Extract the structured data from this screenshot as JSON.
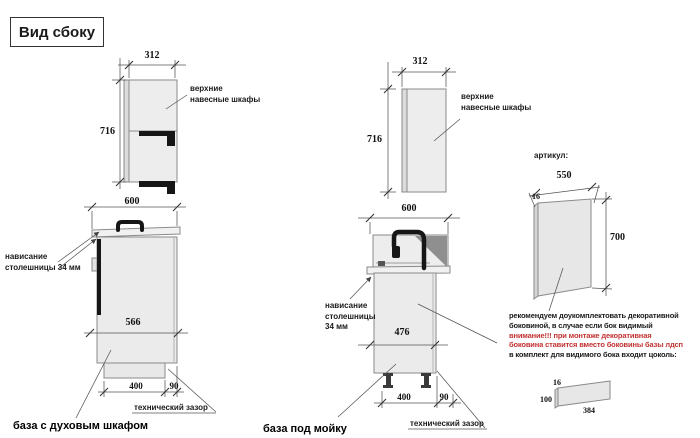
{
  "title": "Вид сбоку",
  "left_unit": {
    "wall_label": "верхние навесные шкафы",
    "overhang_label": "нависание столешницы 34 мм",
    "tech_gap_label": "технический зазор",
    "name_label": "база с духовым шкафом",
    "dims": {
      "wall_width": "312",
      "wall_height": "716",
      "top_width": "600",
      "body_depth": "566",
      "plinth": "400",
      "gap": "90"
    }
  },
  "middle_unit": {
    "wall_label": "верхние навесные шкафы",
    "overhang_label": "нависание столешницы 34 мм",
    "tech_gap_label": "технический зазор",
    "name_label": "база под мойку",
    "dims": {
      "wall_width": "312",
      "wall_height": "716",
      "top_width": "600",
      "body_depth": "476",
      "plinth": "400",
      "gap": "90"
    }
  },
  "side_panel": {
    "article_label": "артикул:",
    "dims": {
      "width": "550",
      "height": "700",
      "thickness": "16"
    }
  },
  "plinth_part": {
    "dims": {
      "thickness": "16",
      "height": "100",
      "length": "384"
    }
  },
  "note": {
    "lines": [
      "рекомендуем доукомплектовать декоративной",
      "боковиной, в случае если бок видимый",
      "внимание!!! при монтаже декоративная",
      "боковина ставится вместо боковины базы лдсп",
      "в комплект для видимого бока входит цоколь:"
    ],
    "warning_color": "#c23232"
  },
  "colors": {
    "background": "#ffffff",
    "outline": "#8a8a8a",
    "cabinet_fill": "#ececec",
    "accent_black": "#161616",
    "warning_red": "#c23232"
  }
}
